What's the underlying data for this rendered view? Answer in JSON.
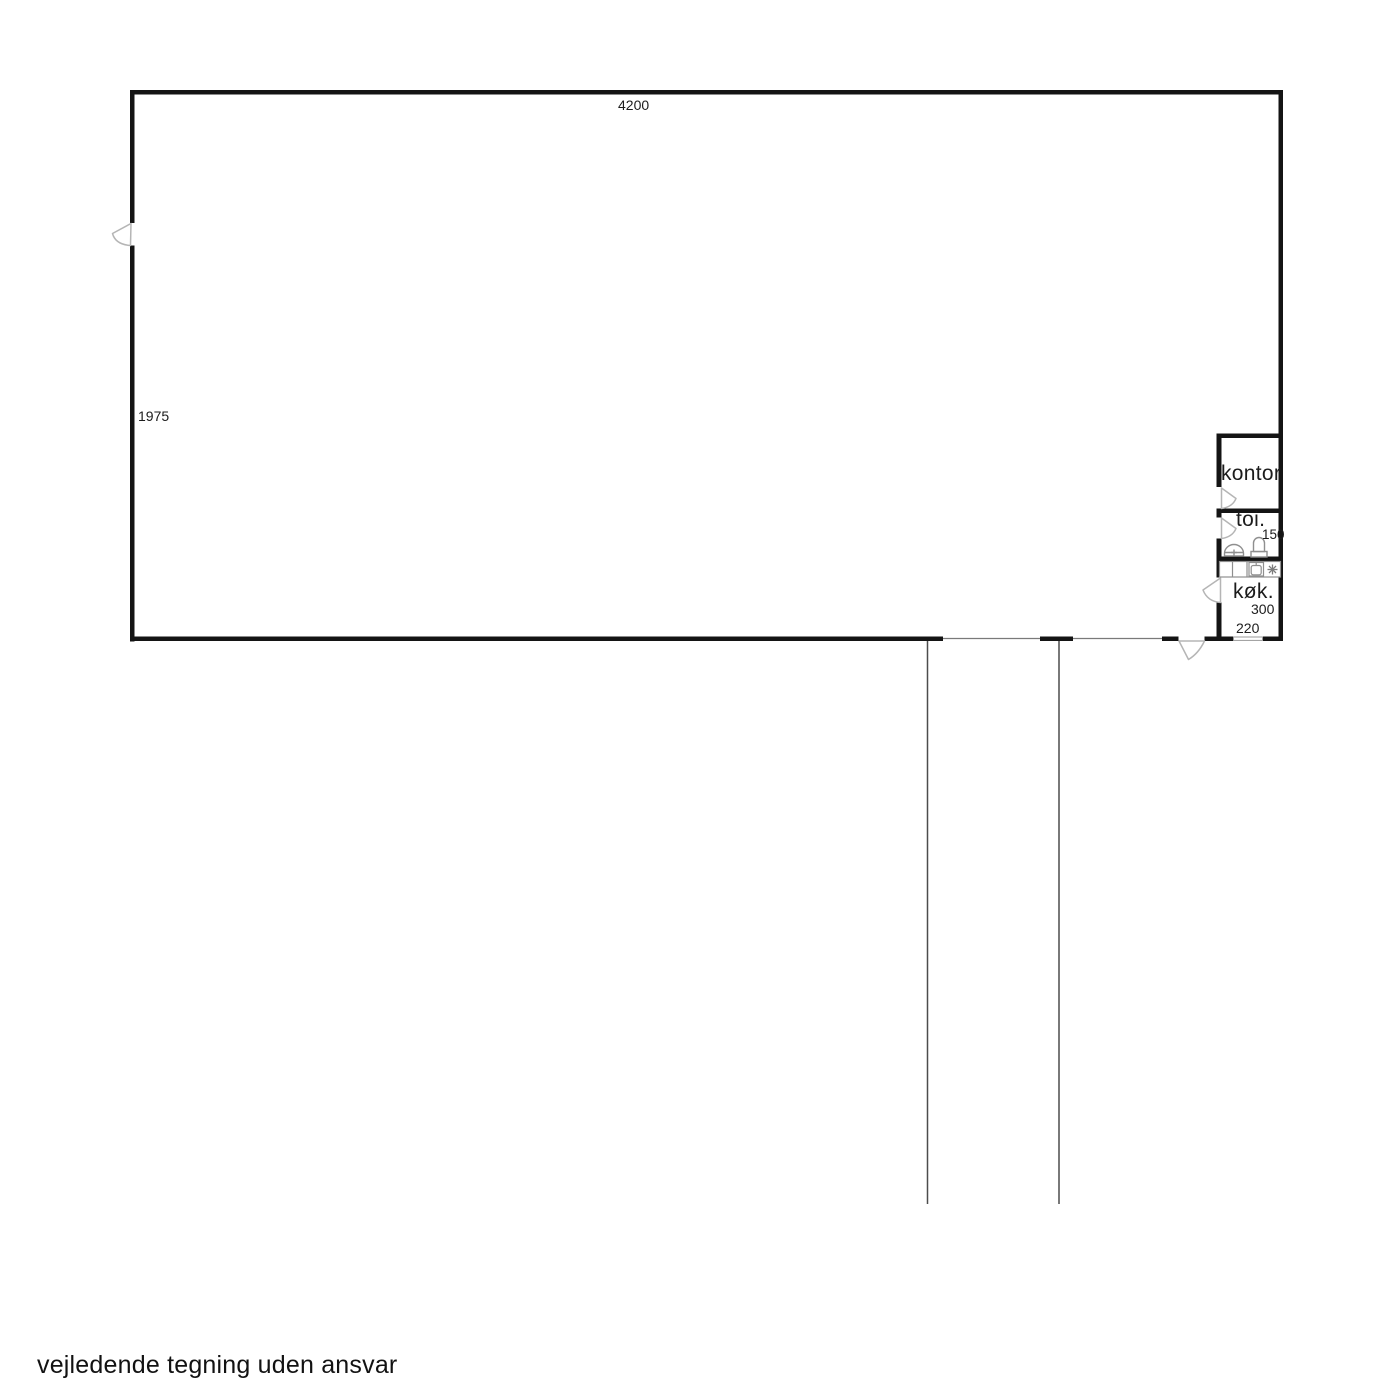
{
  "plan": {
    "title": "warehouse-floor-plan",
    "dimensions": {
      "hall_width": "4200",
      "hall_depth": "1975",
      "toi_width": "150",
      "kok_depth": "300",
      "kok_width": "220"
    },
    "rooms": [
      {
        "label": "kontor"
      },
      {
        "label": "toi."
      },
      {
        "label": "køk."
      }
    ],
    "fixtures": [
      "wash-basin-icon",
      "toilet-icon",
      "kitchen-counter-icon",
      "kitchen-sink-icon",
      "stove-burner-icon"
    ],
    "doors": [
      "hall-left-door",
      "kontor-door",
      "toi-door",
      "kok-door",
      "kok-exterior-door"
    ],
    "colors": {
      "wall": "#141414",
      "door_symbol": "#b5b5b5",
      "fixture": "#8f8f8f",
      "site_line": "#4d4d4d"
    }
  },
  "footer": {
    "disclaimer": "vejledende tegning uden ansvar"
  }
}
